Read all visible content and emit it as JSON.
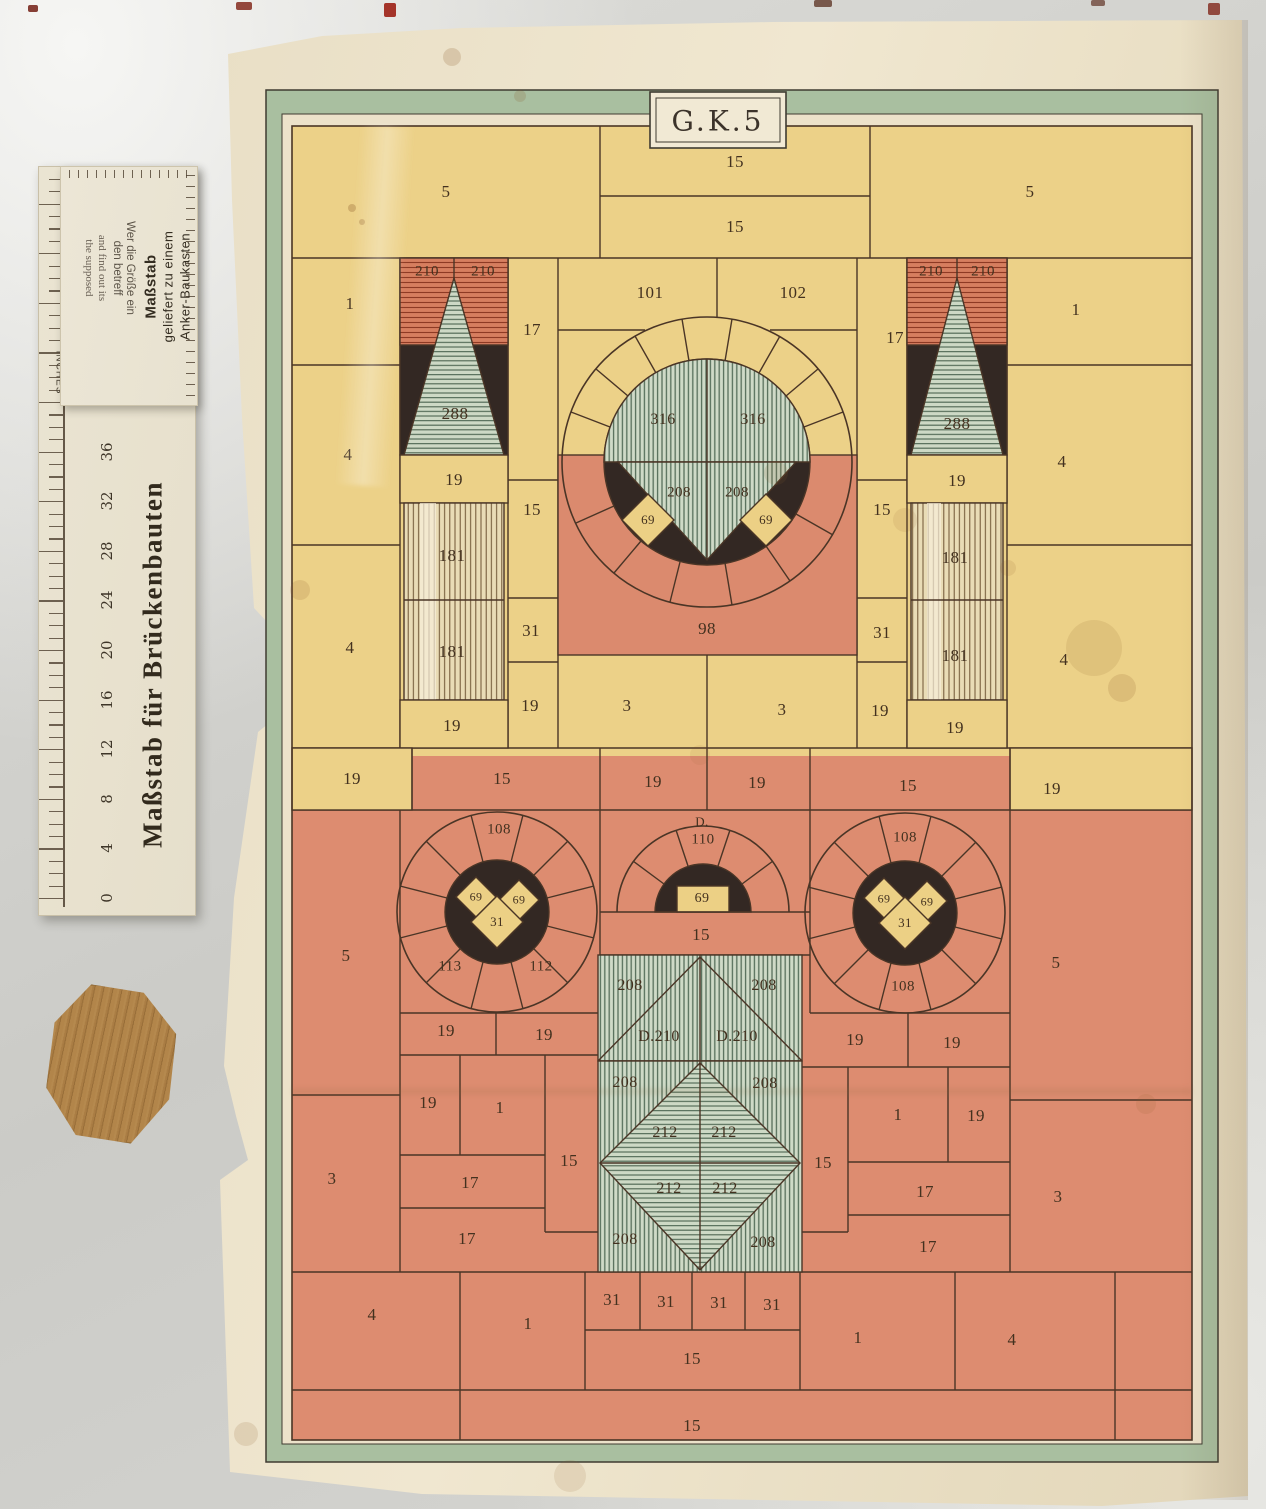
{
  "plan": {
    "title": "G.K.5",
    "colors": {
      "paper": "#ece2ca",
      "yellow": "#ecd188",
      "red": "#dd8c70",
      "green_frame": "#a9bfa0",
      "green_stripe": "#cfdac7",
      "black": "#332823",
      "ink": "#43311f"
    },
    "stone_labels": [
      {
        "t": "5",
        "x": 446,
        "y": 192
      },
      {
        "t": "15",
        "x": 735,
        "y": 162
      },
      {
        "t": "15",
        "x": 735,
        "y": 227
      },
      {
        "t": "5",
        "x": 1030,
        "y": 192
      },
      {
        "t": "210",
        "x": 427,
        "y": 272,
        "fs": 15
      },
      {
        "t": "210",
        "x": 483,
        "y": 272,
        "fs": 15
      },
      {
        "t": "210",
        "x": 931,
        "y": 272,
        "fs": 15
      },
      {
        "t": "210",
        "x": 983,
        "y": 272,
        "fs": 15
      },
      {
        "t": "288",
        "x": 455,
        "y": 414
      },
      {
        "t": "288",
        "x": 957,
        "y": 424
      },
      {
        "t": "19",
        "x": 454,
        "y": 480
      },
      {
        "t": "19",
        "x": 957,
        "y": 481
      },
      {
        "t": "181",
        "x": 452,
        "y": 556
      },
      {
        "t": "181",
        "x": 452,
        "y": 652
      },
      {
        "t": "181",
        "x": 955,
        "y": 558
      },
      {
        "t": "181",
        "x": 955,
        "y": 656
      },
      {
        "t": "19",
        "x": 452,
        "y": 726
      },
      {
        "t": "19",
        "x": 955,
        "y": 728
      },
      {
        "t": "1",
        "x": 350,
        "y": 304
      },
      {
        "t": "4",
        "x": 348,
        "y": 455
      },
      {
        "t": "4",
        "x": 350,
        "y": 648
      },
      {
        "t": "1",
        "x": 1076,
        "y": 310
      },
      {
        "t": "4",
        "x": 1062,
        "y": 462
      },
      {
        "t": "4",
        "x": 1064,
        "y": 660
      },
      {
        "t": "17",
        "x": 532,
        "y": 330
      },
      {
        "t": "15",
        "x": 532,
        "y": 510
      },
      {
        "t": "31",
        "x": 531,
        "y": 631
      },
      {
        "t": "19",
        "x": 530,
        "y": 706
      },
      {
        "t": "17",
        "x": 895,
        "y": 338
      },
      {
        "t": "15",
        "x": 882,
        "y": 510
      },
      {
        "t": "31",
        "x": 882,
        "y": 633
      },
      {
        "t": "19",
        "x": 880,
        "y": 711
      },
      {
        "t": "101",
        "x": 650,
        "y": 293
      },
      {
        "t": "102",
        "x": 793,
        "y": 293
      },
      {
        "t": "316",
        "x": 663,
        "y": 420,
        "fs": 16
      },
      {
        "t": "316",
        "x": 753,
        "y": 420,
        "fs": 16
      },
      {
        "t": "208",
        "x": 679,
        "y": 493,
        "fs": 15
      },
      {
        "t": "208",
        "x": 737,
        "y": 493,
        "fs": 15
      },
      {
        "t": "69",
        "x": 648,
        "y": 520,
        "fs": 13
      },
      {
        "t": "69",
        "x": 766,
        "y": 520,
        "fs": 13
      },
      {
        "t": "98",
        "x": 707,
        "y": 629
      },
      {
        "t": "3",
        "x": 627,
        "y": 706
      },
      {
        "t": "3",
        "x": 782,
        "y": 710
      },
      {
        "t": "19",
        "x": 352,
        "y": 779
      },
      {
        "t": "15",
        "x": 502,
        "y": 779
      },
      {
        "t": "19",
        "x": 653,
        "y": 782
      },
      {
        "t": "19",
        "x": 757,
        "y": 783
      },
      {
        "t": "15",
        "x": 908,
        "y": 786
      },
      {
        "t": "19",
        "x": 1052,
        "y": 789
      },
      {
        "t": "5",
        "x": 346,
        "y": 956
      },
      {
        "t": "5",
        "x": 1056,
        "y": 963
      },
      {
        "t": "3",
        "x": 332,
        "y": 1179
      },
      {
        "t": "3",
        "x": 1058,
        "y": 1197
      },
      {
        "t": "108",
        "x": 499,
        "y": 830,
        "fs": 15
      },
      {
        "t": "113",
        "x": 450,
        "y": 967,
        "fs": 15
      },
      {
        "t": "112",
        "x": 541,
        "y": 967,
        "fs": 15
      },
      {
        "t": "69",
        "x": 476,
        "y": 897,
        "fs": 12
      },
      {
        "t": "69",
        "x": 519,
        "y": 900,
        "fs": 12
      },
      {
        "t": "31",
        "x": 497,
        "y": 922,
        "fs": 13
      },
      {
        "t": "108",
        "x": 905,
        "y": 838,
        "fs": 15
      },
      {
        "t": "108",
        "x": 903,
        "y": 987,
        "fs": 15
      },
      {
        "t": "69",
        "x": 884,
        "y": 899,
        "fs": 12
      },
      {
        "t": "69",
        "x": 927,
        "y": 902,
        "fs": 12
      },
      {
        "t": "31",
        "x": 905,
        "y": 923,
        "fs": 13
      },
      {
        "t": "D.",
        "x": 702,
        "y": 822,
        "fs": 13
      },
      {
        "t": "110",
        "x": 703,
        "y": 840,
        "fs": 15
      },
      {
        "t": "69",
        "x": 702,
        "y": 899,
        "fs": 14
      },
      {
        "t": "15",
        "x": 701,
        "y": 935
      },
      {
        "t": "208",
        "x": 630,
        "y": 986,
        "fs": 16
      },
      {
        "t": "208",
        "x": 764,
        "y": 986,
        "fs": 16
      },
      {
        "t": "D.210",
        "x": 659,
        "y": 1037,
        "fs": 16
      },
      {
        "t": "D.210",
        "x": 737,
        "y": 1037,
        "fs": 16
      },
      {
        "t": "208",
        "x": 625,
        "y": 1083,
        "fs": 16
      },
      {
        "t": "208",
        "x": 765,
        "y": 1084,
        "fs": 16
      },
      {
        "t": "212",
        "x": 665,
        "y": 1133,
        "fs": 16
      },
      {
        "t": "212",
        "x": 724,
        "y": 1133,
        "fs": 16
      },
      {
        "t": "212",
        "x": 669,
        "y": 1189,
        "fs": 16
      },
      {
        "t": "212",
        "x": 725,
        "y": 1189,
        "fs": 16
      },
      {
        "t": "208",
        "x": 625,
        "y": 1240,
        "fs": 16
      },
      {
        "t": "208",
        "x": 763,
        "y": 1243,
        "fs": 16
      },
      {
        "t": "19",
        "x": 446,
        "y": 1031
      },
      {
        "t": "19",
        "x": 544,
        "y": 1035
      },
      {
        "t": "19",
        "x": 428,
        "y": 1103
      },
      {
        "t": "1",
        "x": 500,
        "y": 1108
      },
      {
        "t": "15",
        "x": 569,
        "y": 1161
      },
      {
        "t": "17",
        "x": 470,
        "y": 1183
      },
      {
        "t": "17",
        "x": 467,
        "y": 1239
      },
      {
        "t": "19",
        "x": 855,
        "y": 1040
      },
      {
        "t": "19",
        "x": 952,
        "y": 1043
      },
      {
        "t": "1",
        "x": 898,
        "y": 1115
      },
      {
        "t": "19",
        "x": 976,
        "y": 1116
      },
      {
        "t": "15",
        "x": 823,
        "y": 1163
      },
      {
        "t": "17",
        "x": 925,
        "y": 1192
      },
      {
        "t": "17",
        "x": 928,
        "y": 1247
      },
      {
        "t": "31",
        "x": 612,
        "y": 1300
      },
      {
        "t": "31",
        "x": 666,
        "y": 1302
      },
      {
        "t": "31",
        "x": 719,
        "y": 1303
      },
      {
        "t": "31",
        "x": 772,
        "y": 1305
      },
      {
        "t": "15",
        "x": 692,
        "y": 1359
      },
      {
        "t": "4",
        "x": 372,
        "y": 1315
      },
      {
        "t": "1",
        "x": 528,
        "y": 1324
      },
      {
        "t": "1",
        "x": 858,
        "y": 1338
      },
      {
        "t": "4",
        "x": 1012,
        "y": 1340
      },
      {
        "t": "15",
        "x": 692,
        "y": 1426
      }
    ]
  },
  "ruler": {
    "big_title": "Maßstab für Brückenbauten",
    "inches_label": "INCHES",
    "scale_numbers": [
      "36",
      "32",
      "28",
      "24",
      "20",
      "16",
      "12",
      "8",
      "4",
      "0"
    ],
    "card_lines": [
      "Maßstab",
      "geliefert zu einem",
      "Anker-Baukasten"
    ],
    "faint_lines_en": [
      "and find out its",
      "the supposed"
    ],
    "faint_lines_de": [
      "Wer die Größe ein",
      "den betreff"
    ]
  }
}
